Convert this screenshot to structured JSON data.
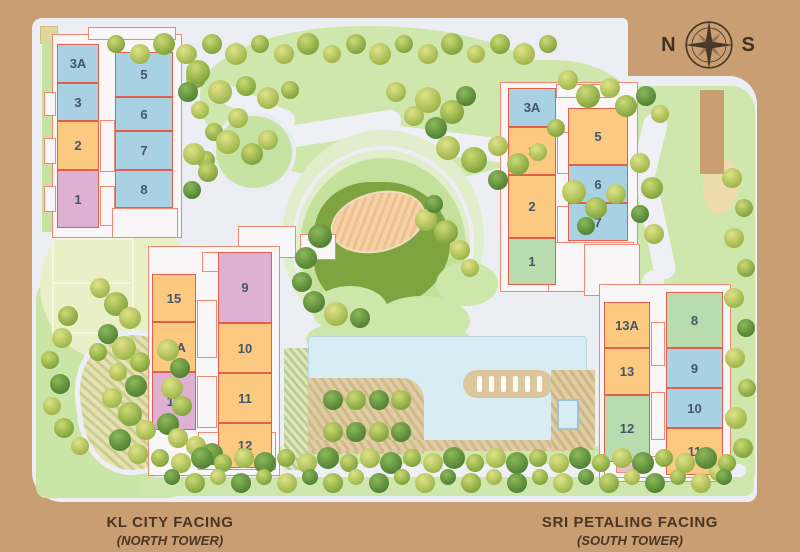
{
  "site_plan": {
    "background_color": "#c99e73",
    "compass": {
      "north_label": "N",
      "south_label": "S"
    },
    "palette": {
      "blue": "#a8d1e4",
      "orange": "#fcc981",
      "pink": "#deb0d3",
      "green": "#b9dcae",
      "unit_outline": "#e2604b",
      "unit_text": "#44566b",
      "caption_text": "#4b3523",
      "pool": "#d7ecf3",
      "lawn": "#cfe7ad",
      "mound": "#7ea440"
    },
    "towers": [
      {
        "id": "north-tower",
        "caption_line1": "KL CITY FACING",
        "caption_line2": "(NORTH TOWER)",
        "wings": [
          {
            "id": "upper",
            "units": [
              {
                "label": "3A",
                "color": "blue"
              },
              {
                "label": "3",
                "color": "blue"
              },
              {
                "label": "2",
                "color": "orange"
              },
              {
                "label": "1",
                "color": "pink"
              },
              {
                "label": "5",
                "color": "blue"
              },
              {
                "label": "6",
                "color": "blue"
              },
              {
                "label": "7",
                "color": "blue"
              },
              {
                "label": "8",
                "color": "blue"
              }
            ]
          },
          {
            "id": "lower",
            "units": [
              {
                "label": "15",
                "color": "orange"
              },
              {
                "label": "13A",
                "color": "orange"
              },
              {
                "label": "13",
                "color": "pink"
              },
              {
                "label": "9",
                "color": "pink"
              },
              {
                "label": "10",
                "color": "orange"
              },
              {
                "label": "11",
                "color": "orange"
              },
              {
                "label": "12",
                "color": "orange"
              }
            ]
          }
        ]
      },
      {
        "id": "south-tower",
        "caption_line1": "SRI PETALING FACING",
        "caption_line2": "(SOUTH TOWER)",
        "wings": [
          {
            "id": "upper",
            "units": [
              {
                "label": "3A",
                "color": "blue"
              },
              {
                "label": "3",
                "color": "orange"
              },
              {
                "label": "2",
                "color": "orange"
              },
              {
                "label": "1",
                "color": "green"
              },
              {
                "label": "5",
                "color": "orange"
              },
              {
                "label": "6",
                "color": "blue"
              },
              {
                "label": "7",
                "color": "blue"
              }
            ]
          },
          {
            "id": "lower",
            "units": [
              {
                "label": "13A",
                "color": "orange"
              },
              {
                "label": "13",
                "color": "orange"
              },
              {
                "label": "12",
                "color": "green"
              },
              {
                "label": "8",
                "color": "green"
              },
              {
                "label": "9",
                "color": "blue"
              },
              {
                "label": "10",
                "color": "blue"
              },
              {
                "label": "11",
                "color": "orange"
              }
            ]
          }
        ]
      }
    ]
  }
}
